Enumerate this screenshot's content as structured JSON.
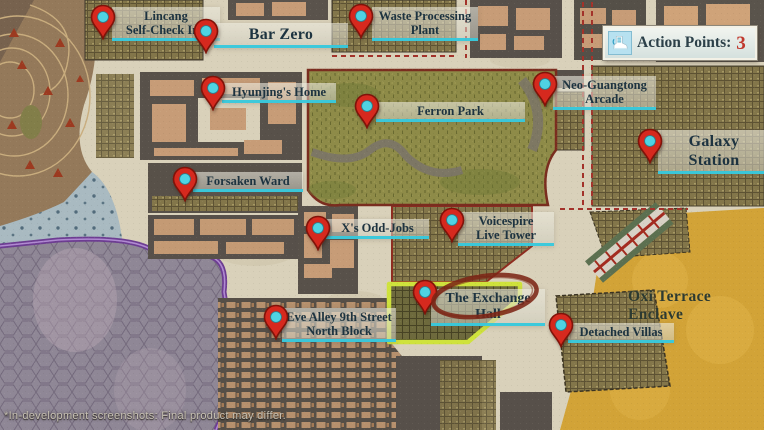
{
  "action_points": {
    "icon": "boot-icon",
    "label": "Action Points:",
    "value": "3",
    "value_color": "#c0392e"
  },
  "disclaimer": "*In-development screenshots: Final product may differ.",
  "regions": [
    {
      "id": "oxi-terrace-enclave",
      "label": "Oxi Terrace Enclave"
    }
  ],
  "colors": {
    "pin_body": "#d6291e",
    "pin_border": "#801309",
    "pin_dot": "#4fd3e3",
    "label_underline": "#34c7db",
    "label_text": "#1d3340",
    "highlight_outline": "#cfe23c",
    "annotation_circle": "#7c2516",
    "park_green": "#8e8b48",
    "enclave_gold": "#d2a337",
    "street_cream": "#d9d1ba"
  },
  "locations": [
    {
      "id": "lincang-self-check-inn",
      "lines": [
        "Lincang",
        "Self-Check Inn"
      ],
      "pin": {
        "x": 103,
        "y": 40
      },
      "box": {
        "left": 112,
        "top": 7,
        "width": 100
      },
      "size": "sm"
    },
    {
      "id": "bar-zero",
      "lines": [
        "Bar Zero"
      ],
      "pin": {
        "x": 206,
        "y": 54
      },
      "box": {
        "left": 214,
        "top": 23,
        "width": 126
      },
      "size": "lg"
    },
    {
      "id": "waste-processing-plant",
      "lines": [
        "Waste Processing",
        "Plant"
      ],
      "pin": {
        "x": 361,
        "y": 39
      },
      "box": {
        "left": 372,
        "top": 7,
        "width": 98
      },
      "size": "sm"
    },
    {
      "id": "hyunjings-home",
      "lines": [
        "Hyunjing's Home"
      ],
      "pin": {
        "x": 213,
        "y": 111
      },
      "box": {
        "left": 222,
        "top": 83,
        "width": 106
      },
      "size": "sm"
    },
    {
      "id": "ferron-park",
      "lines": [
        "Ferron Park"
      ],
      "pin": {
        "x": 367,
        "y": 129
      },
      "box": {
        "left": 376,
        "top": 102,
        "width": 141
      },
      "size": "sm"
    },
    {
      "id": "neo-guangtong-arcade",
      "lines": [
        "Neo-Guangtong",
        "Arcade"
      ],
      "pin": {
        "x": 545,
        "y": 107
      },
      "box": {
        "left": 553,
        "top": 76,
        "width": 95
      },
      "size": "sm"
    },
    {
      "id": "galaxy-station",
      "lines": [
        "Galaxy Station"
      ],
      "pin": {
        "x": 650,
        "y": 164
      },
      "box": {
        "left": 658,
        "top": 130,
        "width": 104
      },
      "size": "lg"
    },
    {
      "id": "forsaken-ward",
      "lines": [
        "Forsaken Ward"
      ],
      "pin": {
        "x": 185,
        "y": 202
      },
      "box": {
        "left": 193,
        "top": 172,
        "width": 102
      },
      "size": "sm"
    },
    {
      "id": "xs-odd-jobs",
      "lines": [
        "X's Odd-Jobs"
      ],
      "pin": {
        "x": 318,
        "y": 251
      },
      "box": {
        "left": 326,
        "top": 219,
        "width": 95
      },
      "size": "sm"
    },
    {
      "id": "voicespire-live-tower",
      "lines": [
        "Voicespire",
        "Live Tower"
      ],
      "pin": {
        "x": 452,
        "y": 243
      },
      "box": {
        "left": 458,
        "top": 212,
        "width": 88
      },
      "size": "sm"
    },
    {
      "id": "the-exchange-hall",
      "lines": [
        "The Exchange Hall"
      ],
      "pin": {
        "x": 425,
        "y": 315
      },
      "box": {
        "left": 431,
        "top": 289,
        "width": 106
      },
      "size": "md"
    },
    {
      "id": "eve-alley-9th-street-north-block",
      "lines": [
        "Eve Alley 9th Street",
        "North Block"
      ],
      "pin": {
        "x": 276,
        "y": 340
      },
      "box": {
        "left": 282,
        "top": 308,
        "width": 106
      },
      "size": "sm"
    },
    {
      "id": "detached-villas",
      "lines": [
        "Detached Villas"
      ],
      "pin": {
        "x": 561,
        "y": 348
      },
      "box": {
        "left": 568,
        "top": 323,
        "width": 98
      },
      "size": "sm"
    }
  ]
}
